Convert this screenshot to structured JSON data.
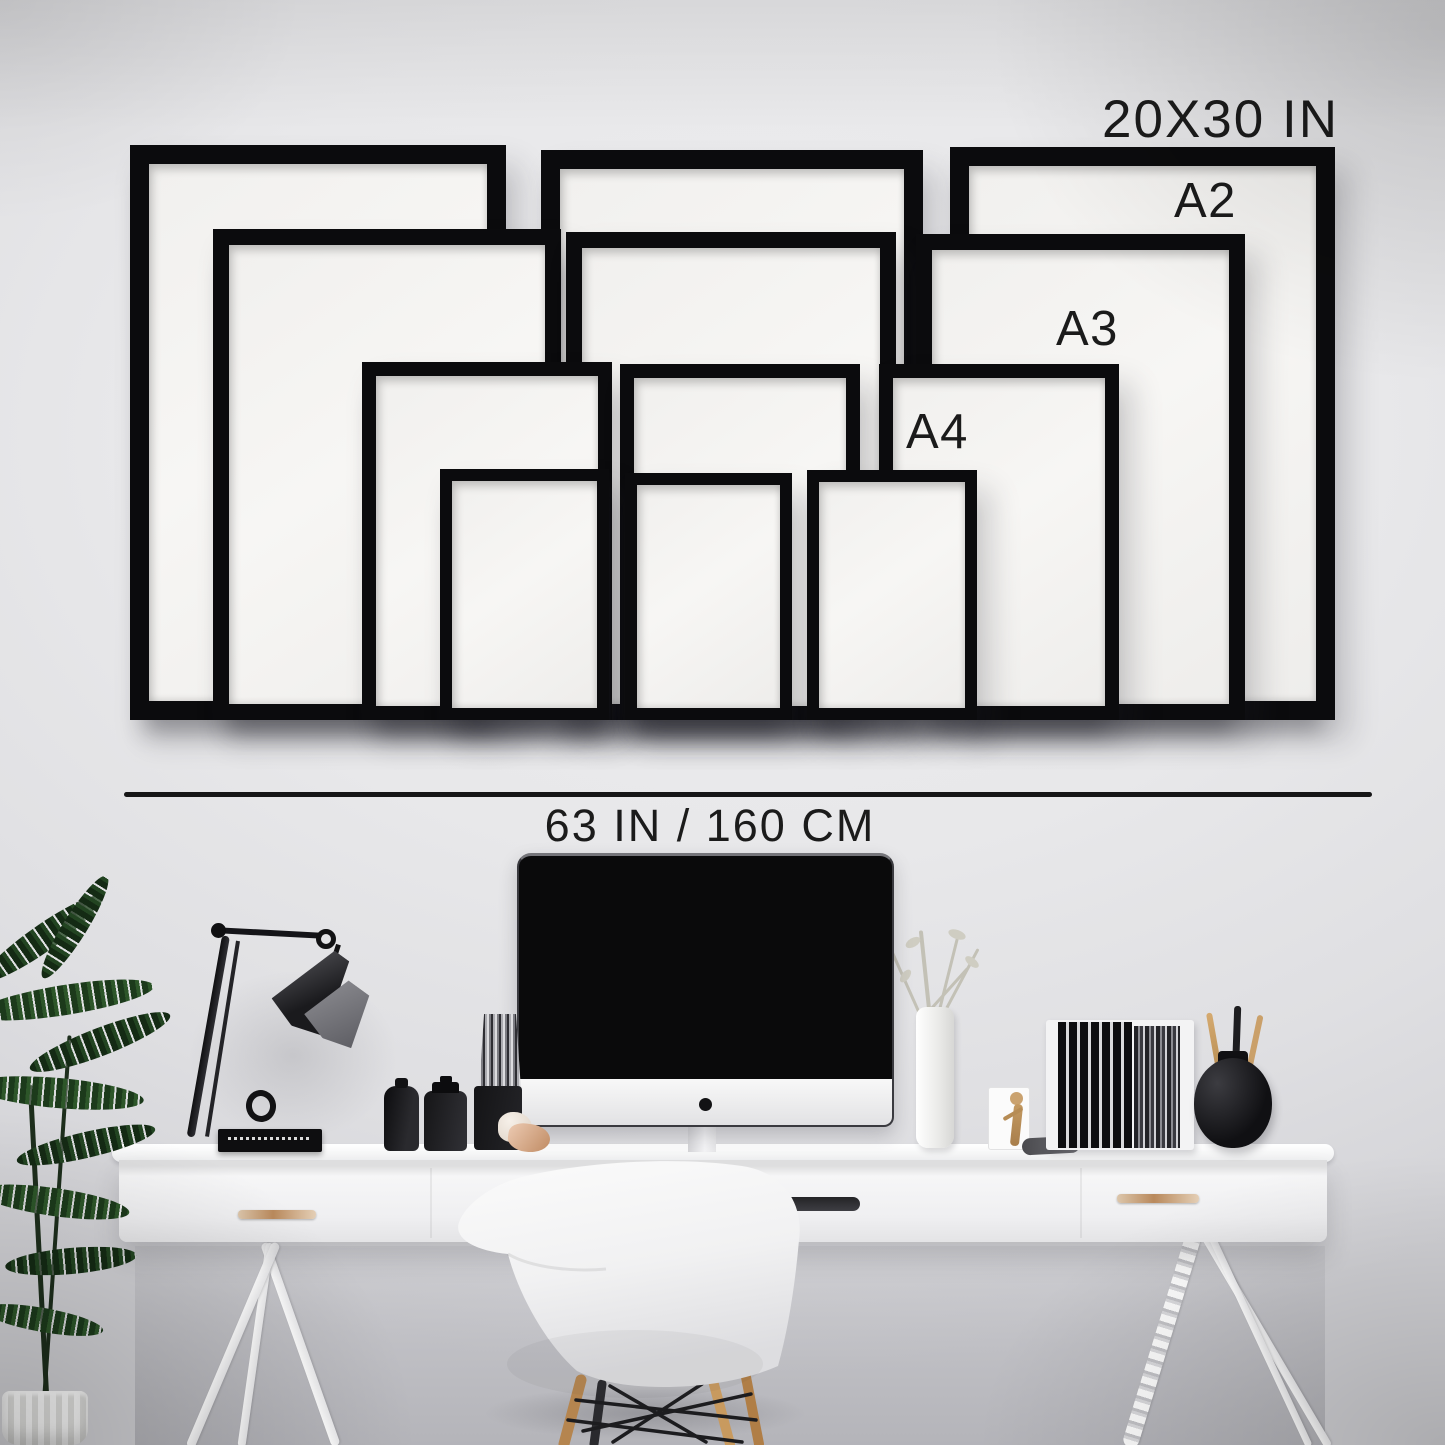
{
  "scene": {
    "description": "Black picture frame size guide mockup on a wall above a white desk workspace",
    "labels": {
      "frame_xl": "20X30 IN",
      "frame_a2": "A2",
      "frame_a3": "A3",
      "frame_a4": "A4",
      "wall_width": "63 IN / 160 CM"
    },
    "frames": {
      "sizes": [
        "20X30 IN",
        "A2",
        "A3",
        "A4"
      ],
      "count_per_size": 3
    },
    "colors": {
      "wall": "#e8e8ea",
      "frame_black": "#0b0b0d",
      "mat_white": "#f6f5f3",
      "text": "#1b1b1b",
      "desk_white": "#f5f5f6",
      "wood_accent": "#bf9164",
      "plant_green": "#2c5129",
      "monitor_black": "#0a0a0b"
    }
  }
}
